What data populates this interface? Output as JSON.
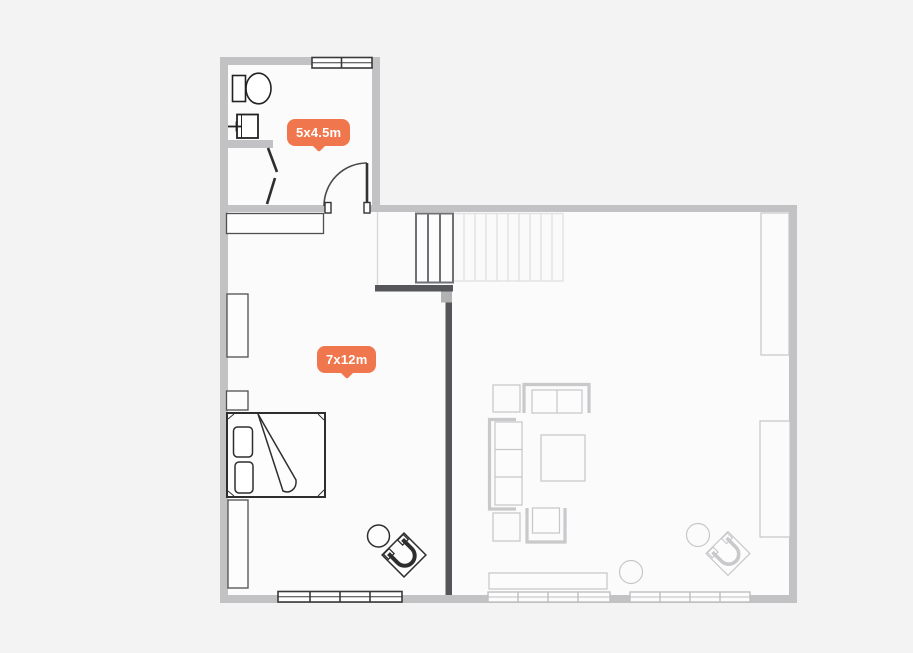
{
  "plan": {
    "labels": [
      {
        "room": "bathroom",
        "text": "5x4.5m"
      },
      {
        "room": "bedroom",
        "text": "7x12m"
      }
    ],
    "colors": {
      "badge_background": "#F0764E",
      "badge_text": "#FFFFFF",
      "wall": "#C2C1C3",
      "interior_wall_dark": "#55565A",
      "background": "#F4F3F4",
      "floor": "#FBFBFB",
      "furniture_dark": "#2E2E2E",
      "furniture_light": "#C7C6C8"
    },
    "icons": [
      "toilet-icon",
      "sink-icon",
      "bathroom-door-icon",
      "bedroom-door-icon",
      "window-icon",
      "stairs-icon",
      "closet-icon",
      "wardrobe-icon",
      "bed-icon",
      "side-table-icon",
      "armchair-icon",
      "loveseat-icon",
      "sofa-icon",
      "coffee-table-icon",
      "end-table-icon",
      "sideboard-icon",
      "plant-icon",
      "shelf-icon"
    ]
  }
}
